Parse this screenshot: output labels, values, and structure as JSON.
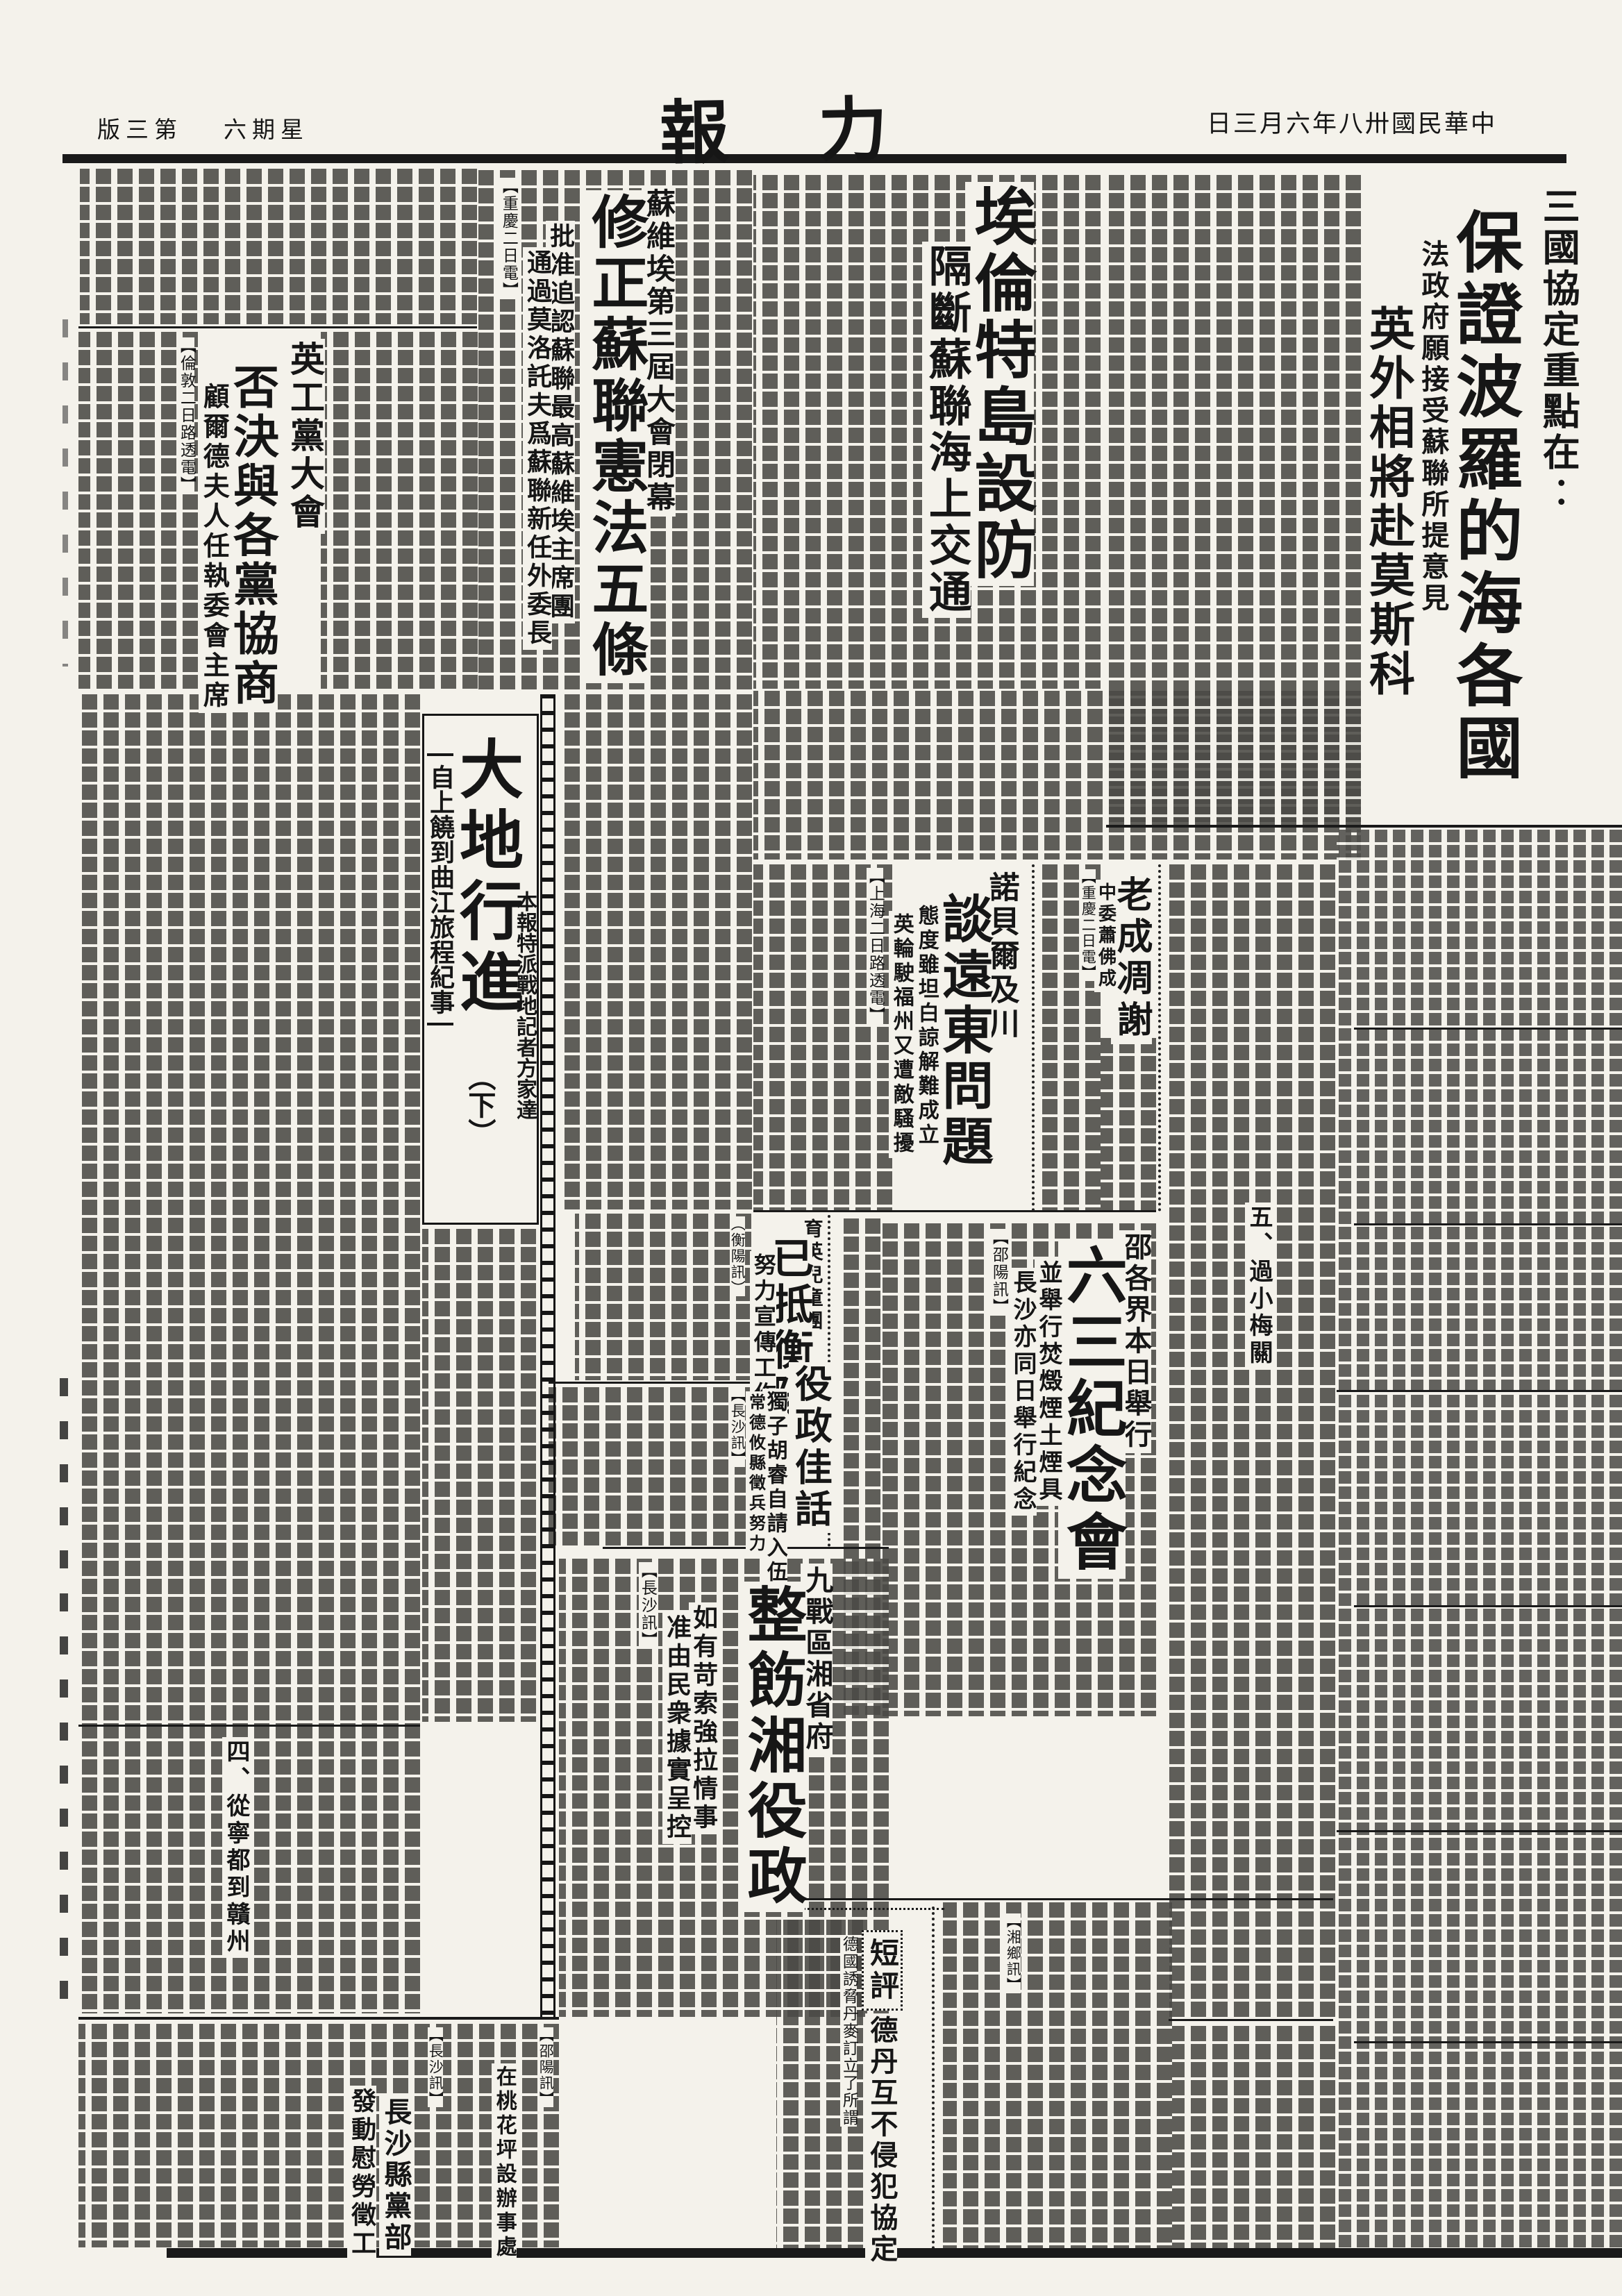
{
  "page": {
    "edition": "版三第",
    "weekday": "六期星",
    "masthead": "報　力",
    "date": "日三月六年八卅國民華中"
  },
  "stories": {
    "lead": {
      "kicker": "三國協定重點在︰",
      "headline": "保證波羅的海各國",
      "subhead": "法政府願接受蘇聯所提意見",
      "deck": "英外相將赴莫斯科"
    },
    "island": {
      "headline": "埃倫特島設防",
      "subhead": "隔斷蘇聯海上交通"
    },
    "soviet": {
      "kicker": "蘇維埃第三屆大會閉幕",
      "headline": "修正蘇聯憲法五條",
      "subhead1": "批准追認蘇聯最高蘇維埃主席團",
      "subhead2": "通過莫洛託夫爲蘇聯新任外委長",
      "dateline": "【重慶二日電】"
    },
    "labour": {
      "kicker": "英工黨大會",
      "headline": "否決與各黨協商",
      "subhead": "顧爾德夫人任執委會主席",
      "dateline": "【倫敦二日路透電】"
    },
    "feature": {
      "title": "大地行進",
      "part": "（下）",
      "subtitle": "自上饒到曲江旅程紀事",
      "credit": "本報特派戰地記者方家達",
      "section4": "四、從寧都到贛州",
      "section5": "五、過小梅關"
    },
    "fareast": {
      "kicker": "諾貝爾及川",
      "headline": "談遠東問題",
      "subhead1": "態度雖坦白諒解難成立",
      "subhead2": "英輪駛福州又遭敵騷擾",
      "dateline": "【上海二日路透電】"
    },
    "obituary": {
      "headline": "老成凋謝",
      "subhead": "中委蕭佛成",
      "dateline": "【重慶二日電】"
    },
    "memorial": {
      "kicker": "邵各界本日舉行",
      "headline": "六三紀念會",
      "subhead1": "並舉行焚燬煙土煙具",
      "subhead2": "長沙亦同日舉行紀念",
      "dateline": "【邵陽訊】"
    },
    "children": {
      "kicker": "育英兒童團",
      "headline": "已抵衡陽",
      "subhead": "努力宣傳工作",
      "dateline": "（衡陽訊）"
    },
    "conscription": {
      "headline": "役政佳話",
      "subhead1": "獨子胡睿自請入伍",
      "subhead2": "常德攸縣徵兵努力",
      "dateline": "【長沙訊】"
    },
    "hunan": {
      "kicker": "九戰區湘省府",
      "headline": "整飭湘役政",
      "subhead1": "如有苛索強拉情事",
      "subhead2": "准由民衆據實呈控",
      "dateline": "【長沙訊】"
    },
    "editorial": {
      "label": "短評",
      "headline": "德丹互不侵犯協定",
      "lead": "德國誘脅丹麥訂立了所謂"
    },
    "party": {
      "headline": "長沙縣黨部",
      "subhead": "發動慰勞徵工",
      "dateline": "【長沙訊】"
    },
    "youth": {
      "headline": "在桃花坪設辦事處",
      "dateline": "【邵陽訊】"
    },
    "xiangxiang": {
      "dateline": "【湘鄉訊】"
    }
  }
}
